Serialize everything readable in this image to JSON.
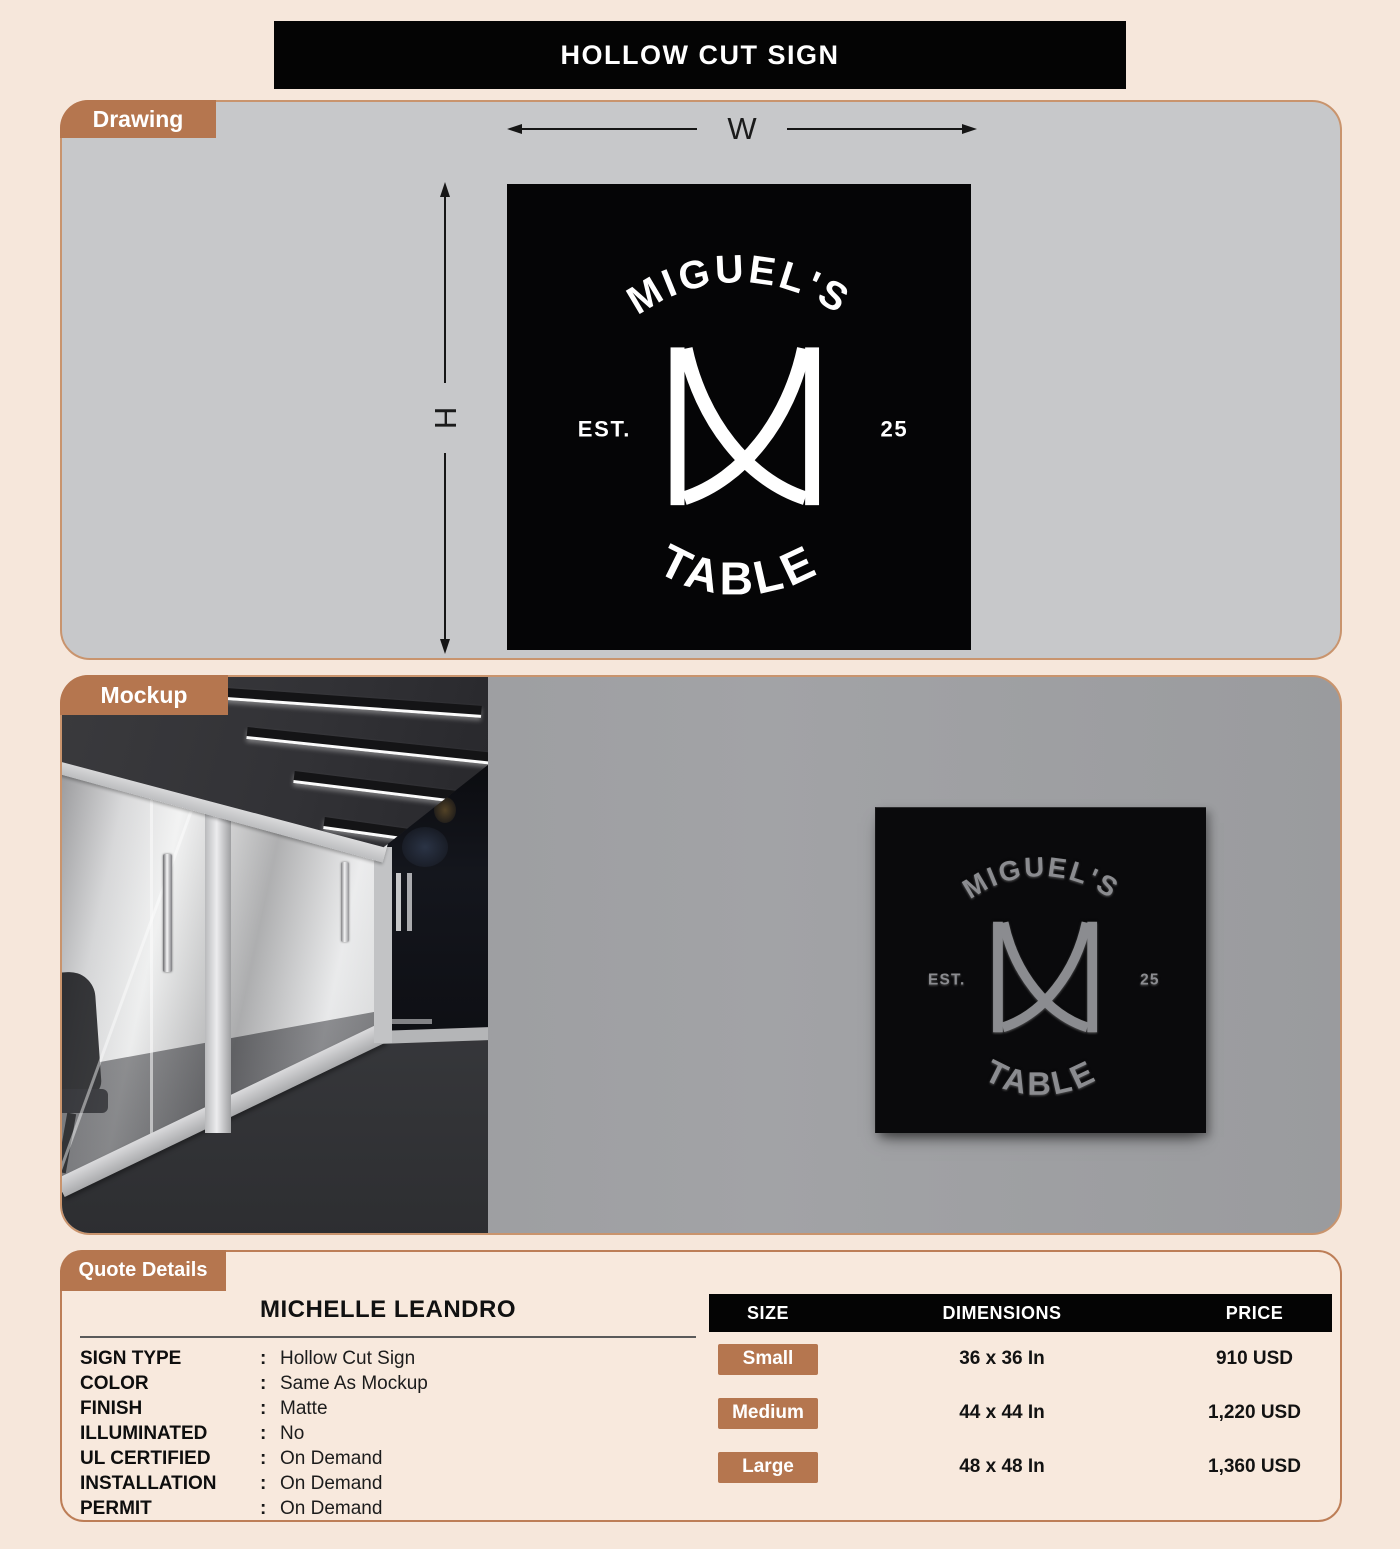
{
  "page": {
    "title": "HOLLOW CUT SIGN"
  },
  "drawing": {
    "tab": "Drawing",
    "width_label": "W",
    "height_label": "H"
  },
  "logo": {
    "top_text": "MIGUEL'S",
    "left_text": "EST.",
    "right_text": "25",
    "bottom_text": "TABLE",
    "monogram": "M"
  },
  "mockup": {
    "tab": "Mockup"
  },
  "quote": {
    "tab": "Quote Details",
    "customer": "MICHELLE LEANDRO",
    "colon": ":",
    "specs": [
      {
        "label": "SIGN TYPE",
        "value": "Hollow Cut Sign"
      },
      {
        "label": "COLOR",
        "value": "Same As Mockup"
      },
      {
        "label": "FINISH",
        "value": "Matte"
      },
      {
        "label": "ILLUMINATED",
        "value": "No"
      },
      {
        "label": "UL CERTIFIED",
        "value": "On Demand"
      },
      {
        "label": "INSTALLATION",
        "value": "On Demand"
      },
      {
        "label": "PERMIT",
        "value": "On Demand"
      }
    ]
  },
  "pricing": {
    "headers": [
      "SIZE",
      "DIMENSIONS",
      "PRICE"
    ],
    "rows": [
      {
        "size": "Small",
        "dimensions": "36 x 36 In",
        "price": "910 USD"
      },
      {
        "size": "Medium",
        "dimensions": "44 x 44 In",
        "price": "1,220 USD"
      },
      {
        "size": "Large",
        "dimensions": "48 x 48 In",
        "price": "1,360 USD"
      }
    ]
  },
  "colors": {
    "accent_brown": "#b5764f",
    "panel_border": "#c9946d",
    "drawing_panel_gray": "#c7c8ca",
    "wall_gray": "#9b9c9f",
    "sign_black": "#050506",
    "engraved_gray": "#8b8c90",
    "page_background": "#f6e7db"
  }
}
